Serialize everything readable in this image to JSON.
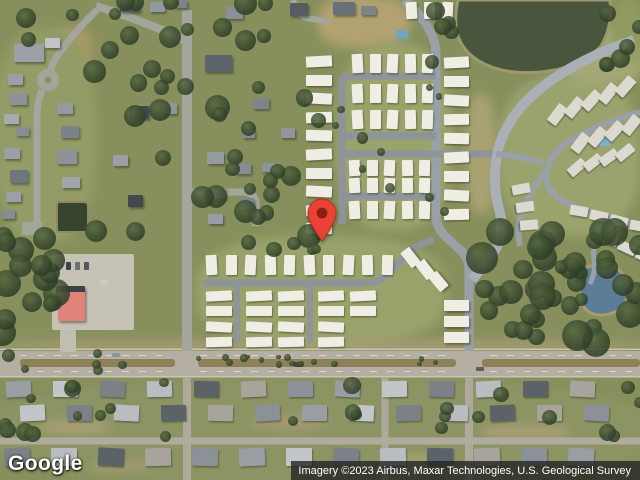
{
  "meta": {
    "width": 640,
    "height": 480,
    "view": "satellite"
  },
  "watermark": {
    "label": "Google"
  },
  "attribution": {
    "text": "Imagery ©2023 Airbus, Maxar Technologies, U.S. Geological Survey"
  },
  "pin": {
    "x": 322,
    "tip_y": 241,
    "fill": "#EA4335",
    "stroke": "#b3271c",
    "dot": "#8A1F11"
  },
  "terrain": {
    "base": "#87905d",
    "patches": [
      {
        "x": 318,
        "y": -4,
        "w": 92,
        "h": 52,
        "c": "#b2a271"
      },
      {
        "x": 56,
        "y": 26,
        "w": 36,
        "h": 46,
        "c": "#ab9868"
      },
      {
        "x": -6,
        "y": 28,
        "w": 102,
        "h": 215,
        "c": "#939c66"
      },
      {
        "x": 196,
        "y": 236,
        "w": 250,
        "h": 112,
        "c": "#99a26b"
      },
      {
        "x": 336,
        "y": 44,
        "w": 116,
        "h": 186,
        "c": "#9aa36c"
      },
      {
        "x": 498,
        "y": 76,
        "w": 142,
        "h": 160,
        "c": "#9aa36e"
      },
      {
        "x": 560,
        "y": 26,
        "w": 84,
        "h": 60,
        "c": "#a3a876"
      },
      {
        "x": -8,
        "y": 378,
        "w": 656,
        "h": 110,
        "c": "#8c9463"
      },
      {
        "x": -4,
        "y": 340,
        "w": 648,
        "h": 12,
        "c": "#a59c74"
      },
      {
        "x": 612,
        "y": -4,
        "w": 32,
        "h": 66,
        "c": "#909a61"
      },
      {
        "x": 466,
        "y": 94,
        "w": 30,
        "h": 120,
        "c": "#a8a273"
      },
      {
        "x": 40,
        "y": 420,
        "w": 70,
        "h": 14,
        "c": "#a89f74"
      },
      {
        "x": 250,
        "y": 415,
        "w": 80,
        "h": 14,
        "c": "#a29a70"
      },
      {
        "x": 480,
        "y": 425,
        "w": 90,
        "h": 14,
        "c": "#a89f74"
      },
      {
        "x": 90,
        "y": 460,
        "w": 60,
        "h": 12,
        "c": "#a29a70"
      },
      {
        "x": 380,
        "y": 455,
        "w": 70,
        "h": 12,
        "c": "#a89f74"
      }
    ]
  },
  "ponds": [
    {
      "name": "retention-pond-top",
      "d": "M458,0 L610,0 Q613,26 601,46 Q582,66 549,71 Q506,77 479,61 Q459,49 456,27 Q455,12 458,0 Z",
      "fill": "#4a553e",
      "stroke": "#9b9a6d",
      "sw": 3
    },
    {
      "name": "pond-right",
      "d": "M585,268 Q606,260 619,270 Q630,280 627,297 Q623,313 603,315 Q586,316 581,301 Q577,283 585,268 Z",
      "fill": "#5c7d97",
      "stroke": "#a89a6e",
      "sw": 3
    },
    {
      "name": "pond-small-left",
      "d": "M59,202 h25 q4,0 4,4 v22 q0,4 -4,4 h-25 q-2,0 -2,-4 v-22 q0,-4 2,-4 z",
      "fill": "#38452e",
      "stroke": "#8e8a5e",
      "sw": 2
    }
  ],
  "highway": {
    "base": {
      "x": 0,
      "y": 351,
      "w": 640,
      "h": 25,
      "c": "#b4afa2"
    },
    "edges": [
      {
        "x": 0,
        "y": 348.5,
        "w": 640,
        "h": 1.5,
        "c": "#c9c4b4"
      },
      {
        "x": 0,
        "y": 376,
        "w": 640,
        "h": 1.5,
        "c": "#c9c4b4"
      }
    ],
    "median_color": "#8d8158",
    "median_segments": [
      {
        "x": 20,
        "y": 359,
        "w": 155,
        "h": 8
      },
      {
        "x": 198,
        "y": 359,
        "w": 258,
        "h": 8
      },
      {
        "x": 482,
        "y": 359,
        "w": 158,
        "h": 8
      }
    ],
    "dash_color": "#d9d6cb",
    "dashes": [
      {
        "d": "M20,355.5 H170",
        "da": "7 10"
      },
      {
        "d": "M200,355.5 H450",
        "da": "7 10"
      },
      {
        "d": "M490,355.5 H632",
        "da": "7 10"
      },
      {
        "d": "M20,371.5 H170",
        "da": "7 10"
      },
      {
        "d": "M200,371.5 H450",
        "da": "7 10"
      },
      {
        "d": "M490,371.5 H632",
        "da": "7 10"
      }
    ]
  },
  "roads": [
    {
      "name": "left-vertical-road",
      "d": "M187,10 V351",
      "w": 10,
      "c": "#a3a69c"
    },
    {
      "name": "left-vertical-road-south",
      "d": "M187,377 V480",
      "w": 8,
      "c": "#ada99b"
    },
    {
      "name": "top-curve-road",
      "d": "M96,6 Q128,16 152,26 Q172,33 187,42",
      "w": 8,
      "c": "#a3a69c"
    },
    {
      "name": "culdesac-diagonal",
      "d": "M97,10 Q78,28 64,47 Q53,60 50,72",
      "w": 7,
      "c": "#a3a69c"
    },
    {
      "name": "culdesac-south",
      "d": "M42,90 Q38,100 37,112 V230",
      "w": 7,
      "c": "#a3a69c"
    },
    {
      "name": "pocket-street",
      "d": "M187,192 H242 Q256,192 256,204 V226",
      "w": 7,
      "c": "#a3a69c"
    },
    {
      "name": "top-stub",
      "d": "M293,0 Q296,12 306,18 L330,22",
      "w": 6,
      "c": "#a3a69c"
    },
    {
      "name": "park-entrance",
      "d": "M404,0 Q416,10 426,24 Q435,38 436,52",
      "w": 9,
      "c": "#9aa0a8"
    },
    {
      "name": "park-collector",
      "d": "M436,52 V214 Q436,228 446,237 L459,249 Q469,257 469,268 V351",
      "w": 9,
      "c": "#9aa0a8"
    },
    {
      "name": "collector-south",
      "d": "M469,377 V480",
      "w": 8,
      "c": "#ada99b"
    },
    {
      "name": "mid-vertical-south",
      "d": "M385,377 V480",
      "w": 7,
      "c": "#ada99b"
    },
    {
      "name": "park-street-left",
      "d": "M342,76 V224",
      "w": 7,
      "c": "#8f939a"
    },
    {
      "name": "park-street-a",
      "d": "M342,76 H436",
      "w": 7,
      "c": "#8f939a"
    },
    {
      "name": "park-street-b",
      "d": "M342,136 H436",
      "w": 7,
      "c": "#8f939a"
    },
    {
      "name": "park-street-c",
      "d": "M342,154 H496",
      "w": 7,
      "c": "#8f939a"
    },
    {
      "name": "park-street-d",
      "d": "M342,196 H436",
      "w": 7,
      "c": "#8f939a"
    },
    {
      "name": "park-south-street",
      "d": "M204,283 H366 Q380,283 390,272 L410,252 Q420,242 434,240",
      "w": 7,
      "c": "#8f939a"
    },
    {
      "name": "park-side-1",
      "d": "M237,283 V342",
      "w": 6,
      "c": "#8f939a"
    },
    {
      "name": "park-side-2",
      "d": "M310,283 V342",
      "w": 6,
      "c": "#8f939a"
    },
    {
      "name": "arc-road",
      "d": "M634,40 Q570,62 534,94 Q506,119 498,150 Q491,183 500,213 Q506,238 489,259 Q480,270 472,280",
      "w": 10,
      "c": "#aab0b6"
    },
    {
      "name": "sub-spur",
      "d": "M496,154 Q520,156 544,163",
      "w": 6,
      "c": "#9aa0a8"
    },
    {
      "name": "sub-street-1",
      "d": "M640,112 Q598,124 568,142 Q548,156 546,175 Q546,192 565,202 Q590,214 620,220 Q632,223 640,227",
      "w": 6,
      "c": "#9aa0a8"
    },
    {
      "name": "sub-street-2",
      "d": "M548,168 Q530,190 522,212 Q516,230 520,246",
      "w": 6,
      "c": "#9aa0a8"
    },
    {
      "name": "sub-street-3",
      "d": "M600,222 Q592,240 594,258 Q596,272 590,284",
      "w": 5,
      "c": "#9aa0a8"
    },
    {
      "name": "bottom-street",
      "d": "M0,441 H640",
      "w": 7,
      "c": "#b0ab9c"
    }
  ],
  "culdesac_circle": {
    "cx": 48,
    "cy": 80,
    "r": 11,
    "c": "#a3a69c",
    "island": "#8b9160",
    "ir": 3.5
  },
  "pads": [
    {
      "x": 52,
      "y": 254,
      "w": 82,
      "h": 76,
      "c": "#c6c2b5"
    },
    {
      "x": 60,
      "y": 330,
      "w": 16,
      "h": 22,
      "c": "#c1bdb0"
    },
    {
      "x": 22,
      "y": 222,
      "w": 20,
      "h": 13,
      "c": "#a3a69c"
    }
  ],
  "pools": [
    {
      "x": 396,
      "y": 30,
      "w": 12,
      "h": 9,
      "c": "#6fa7c2"
    },
    {
      "x": 598,
      "y": 136,
      "w": 13,
      "h": 10,
      "c": "#7fb2c8"
    }
  ],
  "buildings": [
    {
      "x": 14,
      "y": 44,
      "w": 30,
      "h": 18,
      "c": "#9ba1a7"
    },
    {
      "x": 45,
      "y": 38,
      "w": 15,
      "h": 10,
      "c": "#c0c4c8"
    },
    {
      "x": 8,
      "y": 74,
      "w": 15,
      "h": 11,
      "c": "#9aa0a6"
    },
    {
      "x": 10,
      "y": 93,
      "w": 17,
      "h": 12,
      "c": "#8d9399"
    },
    {
      "x": 4,
      "y": 114,
      "w": 15,
      "h": 10,
      "c": "#a5abb0"
    },
    {
      "x": 16,
      "y": 127,
      "w": 13,
      "h": 9,
      "c": "#878d93"
    },
    {
      "x": 4,
      "y": 148,
      "w": 16,
      "h": 11,
      "c": "#9aa0a6"
    },
    {
      "x": 10,
      "y": 170,
      "w": 18,
      "h": 13,
      "c": "#6f757c"
    },
    {
      "x": 6,
      "y": 192,
      "w": 15,
      "h": 10,
      "c": "#9aa0a6"
    },
    {
      "x": 2,
      "y": 210,
      "w": 13,
      "h": 9,
      "c": "#868c92"
    },
    {
      "x": 57,
      "y": 103,
      "w": 16,
      "h": 11,
      "c": "#949aa0"
    },
    {
      "x": 61,
      "y": 126,
      "w": 18,
      "h": 12,
      "c": "#7c8289"
    },
    {
      "x": 57,
      "y": 150,
      "w": 20,
      "h": 14,
      "c": "#8d9399"
    },
    {
      "x": 62,
      "y": 177,
      "w": 18,
      "h": 11,
      "c": "#a0a6ab"
    },
    {
      "x": 120,
      "y": 0,
      "w": 20,
      "h": 12,
      "c": "#50565d"
    },
    {
      "x": 150,
      "y": 2,
      "w": 15,
      "h": 10,
      "c": "#9098a0"
    },
    {
      "x": 175,
      "y": 0,
      "w": 12,
      "h": 8,
      "c": "#7b838b"
    },
    {
      "x": 226,
      "y": 7,
      "w": 17,
      "h": 12,
      "c": "#8a9096"
    },
    {
      "x": 290,
      "y": 3,
      "w": 18,
      "h": 13,
      "c": "#565c63"
    },
    {
      "x": 333,
      "y": 2,
      "w": 22,
      "h": 13,
      "c": "#6a7077"
    },
    {
      "x": 361,
      "y": 6,
      "w": 15,
      "h": 9,
      "c": "#7d838a"
    },
    {
      "x": 130,
      "y": 106,
      "w": 19,
      "h": 13,
      "c": "#42484f"
    },
    {
      "x": 162,
      "y": 103,
      "w": 15,
      "h": 11,
      "c": "#8f959b"
    },
    {
      "x": 113,
      "y": 155,
      "w": 15,
      "h": 11,
      "c": "#9aa0a6"
    },
    {
      "x": 128,
      "y": 195,
      "w": 15,
      "h": 12,
      "c": "#42484f"
    },
    {
      "x": 205,
      "y": 55,
      "w": 27,
      "h": 17,
      "c": "#5d646b"
    },
    {
      "x": 207,
      "y": 152,
      "w": 17,
      "h": 12,
      "c": "#959ba1"
    },
    {
      "x": 236,
      "y": 163,
      "w": 15,
      "h": 11,
      "c": "#868c92"
    },
    {
      "x": 209,
      "y": 188,
      "w": 17,
      "h": 11,
      "c": "#8d9399"
    },
    {
      "x": 239,
      "y": 198,
      "w": 15,
      "h": 11,
      "c": "#7d838a"
    },
    {
      "x": 208,
      "y": 214,
      "w": 15,
      "h": 10,
      "c": "#979da3"
    },
    {
      "x": 253,
      "y": 98,
      "w": 16,
      "h": 11,
      "c": "#7e848a"
    },
    {
      "x": 281,
      "y": 128,
      "w": 14,
      "h": 10,
      "c": "#90969c"
    },
    {
      "x": 243,
      "y": 129,
      "w": 12,
      "h": 9,
      "c": "#858b91"
    },
    {
      "x": 262,
      "y": 163,
      "w": 13,
      "h": 9,
      "c": "#8d9399"
    },
    {
      "x": 56,
      "y": 286,
      "w": 29,
      "h": 7,
      "c": "#3c4048"
    },
    {
      "x": 58,
      "y": 292,
      "w": 27,
      "h": 29,
      "c": "#e2837a",
      "name": "red-roof-building"
    },
    {
      "x": 405,
      "y": 248,
      "w": 11,
      "h": 19,
      "c": "#efede4",
      "r": -38
    },
    {
      "x": 420,
      "y": 260,
      "w": 11,
      "h": 19,
      "c": "#efede4",
      "r": -38
    },
    {
      "x": 433,
      "y": 272,
      "w": 11,
      "h": 19,
      "c": "#efede4",
      "r": -40
    },
    {
      "x": 444,
      "y": 300,
      "w": 25,
      "h": 11,
      "c": "#efede4"
    },
    {
      "x": 444,
      "y": 316,
      "w": 25,
      "h": 11,
      "c": "#efede4"
    },
    {
      "x": 444,
      "y": 332,
      "w": 25,
      "h": 11,
      "c": "#efede4"
    }
  ],
  "house_rows": [
    {
      "x": 306,
      "y": 56,
      "w": 26,
      "h": 11,
      "count": 10,
      "dx": 0,
      "dy": 18.6,
      "c": "#efede4"
    },
    {
      "x": 352,
      "y": 54,
      "w": 11,
      "h": 19,
      "count": 5,
      "dx": 17.5,
      "dy": 0,
      "c": "#efede4"
    },
    {
      "x": 352,
      "y": 84,
      "w": 11,
      "h": 19,
      "count": 5,
      "dx": 17.5,
      "dy": 0,
      "c": "#efede4"
    },
    {
      "x": 352,
      "y": 110,
      "w": 11,
      "h": 19,
      "count": 5,
      "dx": 17.5,
      "dy": 0,
      "c": "#efede4"
    },
    {
      "x": 349,
      "y": 160,
      "w": 11,
      "h": 16,
      "count": 5,
      "dx": 17.5,
      "dy": 0,
      "c": "#efede4"
    },
    {
      "x": 349,
      "y": 178,
      "w": 11,
      "h": 15,
      "count": 5,
      "dx": 17.5,
      "dy": 0,
      "c": "#efede4"
    },
    {
      "x": 349,
      "y": 201,
      "w": 11,
      "h": 18,
      "count": 5,
      "dx": 17.5,
      "dy": 0,
      "c": "#efede4"
    },
    {
      "x": 444,
      "y": 57,
      "w": 25,
      "h": 11,
      "count": 9,
      "dx": 0,
      "dy": 19,
      "c": "#efede4"
    },
    {
      "x": 406,
      "y": 2,
      "w": 11,
      "h": 17,
      "count": 3,
      "dx": 18,
      "dy": 0,
      "c": "#efede4"
    },
    {
      "x": 206,
      "y": 255,
      "w": 11,
      "h": 20,
      "count": 10,
      "dx": 19.5,
      "dy": 0,
      "c": "#efede4"
    },
    {
      "x": 206,
      "y": 291,
      "w": 26,
      "h": 10,
      "count": 4,
      "dx": 0,
      "dy": 15.3,
      "c": "#efede4"
    },
    {
      "x": 246,
      "y": 291,
      "w": 26,
      "h": 10,
      "count": 4,
      "dx": 0,
      "dy": 15.3,
      "c": "#efede4"
    },
    {
      "x": 278,
      "y": 291,
      "w": 26,
      "h": 10,
      "count": 4,
      "dx": 0,
      "dy": 15.3,
      "c": "#efede4"
    },
    {
      "x": 318,
      "y": 291,
      "w": 26,
      "h": 10,
      "count": 4,
      "dx": 0,
      "dy": 15.3,
      "c": "#efede4"
    },
    {
      "x": 350,
      "y": 291,
      "w": 26,
      "h": 10,
      "count": 2,
      "dx": 0,
      "dy": 15.3,
      "c": "#efede4"
    },
    {
      "x": 552,
      "y": 104,
      "w": 11,
      "h": 21,
      "count": 5,
      "dx": 17,
      "dy": -7,
      "rot": 40,
      "c": "#dcdad0"
    },
    {
      "x": 575,
      "y": 133,
      "w": 11,
      "h": 20,
      "count": 4,
      "dx": 17,
      "dy": -6,
      "rot": 40,
      "c": "#dcdad0"
    },
    {
      "x": 516,
      "y": 180,
      "w": 10,
      "h": 18,
      "count": 3,
      "dx": 4,
      "dy": 18,
      "rot": 82,
      "c": "#dcdad0"
    },
    {
      "x": 572,
      "y": 158,
      "w": 10,
      "h": 19,
      "count": 4,
      "dx": 16,
      "dy": -5,
      "rot": 52,
      "c": "#dcdad0"
    },
    {
      "x": 570,
      "y": 206,
      "w": 18,
      "h": 10,
      "count": 4,
      "dx": 20,
      "dy": 5,
      "rot": 12,
      "c": "#dcdad0"
    },
    {
      "x": 600,
      "y": 234,
      "w": 18,
      "h": 10,
      "count": 3,
      "dx": 18,
      "dy": 9,
      "rot": 25,
      "c": "#dcdad0"
    },
    {
      "x": 6,
      "y": 381,
      "w": 25,
      "h": 16,
      "count": 13,
      "dx": 47,
      "dy": 0,
      "palette": true
    },
    {
      "x": 20,
      "y": 405,
      "w": 25,
      "h": 16,
      "count": 13,
      "dx": 47,
      "dy": 0,
      "palette": true
    },
    {
      "x": 4,
      "y": 448,
      "w": 26,
      "h": 18,
      "count": 13,
      "dx": 47,
      "dy": 0,
      "palette": true
    }
  ],
  "house_palette": [
    "#999ea3",
    "#c3c6c9",
    "#7b8187",
    "#b9bcc0",
    "#5b6268",
    "#a9a49b",
    "#8b9196"
  ],
  "vehicles": [
    {
      "x": 294,
      "y": 362,
      "w": 9,
      "h": 5,
      "c": "#43464a"
    },
    {
      "x": 112,
      "y": 353,
      "w": 8,
      "h": 4,
      "c": "#8f9296"
    },
    {
      "x": 476,
      "y": 367,
      "w": 8,
      "h": 4,
      "c": "#5a5d61"
    },
    {
      "x": 66,
      "y": 262,
      "w": 5,
      "h": 8,
      "c": "#3f434a"
    },
    {
      "x": 75,
      "y": 262,
      "w": 5,
      "h": 8,
      "c": "#6b6f76"
    },
    {
      "x": 84,
      "y": 262,
      "w": 5,
      "h": 8,
      "c": "#52565d"
    },
    {
      "x": 100,
      "y": 280,
      "w": 8,
      "h": 5,
      "c": "#caccce"
    }
  ],
  "tree_clusters": [
    {
      "x": 0,
      "y": 228,
      "w": 58,
      "h": 122,
      "count": 16,
      "seed": 7,
      "rmin": 7,
      "rmax": 14
    },
    {
      "x": 478,
      "y": 228,
      "w": 162,
      "h": 118,
      "count": 34,
      "seed": 11,
      "rmin": 8,
      "rmax": 16
    },
    {
      "x": 196,
      "y": 34,
      "w": 128,
      "h": 205,
      "count": 20,
      "seed": 3,
      "rmin": 6,
      "rmax": 13
    },
    {
      "x": 88,
      "y": 40,
      "w": 100,
      "h": 195,
      "count": 12,
      "seed": 5,
      "rmin": 6,
      "rmax": 12
    },
    {
      "x": 0,
      "y": 0,
      "w": 300,
      "h": 40,
      "count": 14,
      "seed": 9,
      "rmin": 6,
      "rmax": 12
    },
    {
      "x": 0,
      "y": 378,
      "w": 640,
      "h": 60,
      "count": 26,
      "seed": 13,
      "rmin": 4,
      "rmax": 9
    },
    {
      "x": 430,
      "y": 0,
      "w": 26,
      "h": 70,
      "count": 5,
      "seed": 17,
      "rmin": 6,
      "rmax": 11
    },
    {
      "x": 606,
      "y": 0,
      "w": 34,
      "h": 78,
      "count": 6,
      "seed": 19,
      "rmin": 6,
      "rmax": 11
    },
    {
      "x": 140,
      "y": 357,
      "w": 320,
      "h": 9,
      "count": 16,
      "seed": 21,
      "rmin": 2,
      "rmax": 4
    },
    {
      "x": 330,
      "y": 50,
      "w": 140,
      "h": 180,
      "count": 10,
      "seed": 23,
      "rmin": 3,
      "rmax": 6
    },
    {
      "x": 0,
      "y": 348,
      "w": 180,
      "h": 24,
      "count": 6,
      "seed": 25,
      "rmin": 4,
      "rmax": 8
    },
    {
      "x": 230,
      "y": 238,
      "w": 90,
      "h": 18,
      "count": 5,
      "seed": 29,
      "rmin": 4,
      "rmax": 8
    },
    {
      "x": 560,
      "y": 252,
      "w": 26,
      "h": 66,
      "count": 6,
      "seed": 27,
      "rmin": 6,
      "rmax": 11
    }
  ],
  "tree_colors": {
    "light": "#55683f",
    "dark": "#2e3d27"
  }
}
